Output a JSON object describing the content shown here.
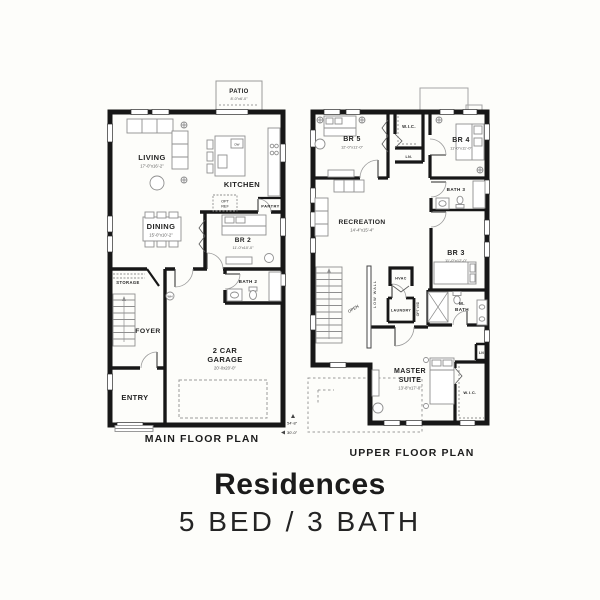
{
  "title": {
    "heading": "Residences",
    "subheading": "5 BED / 3 BATH"
  },
  "main_floor": {
    "caption": "MAIN FLOOR PLAN",
    "depth_marker": "54'-8\"",
    "width_marker": "30'-0\"",
    "rooms": {
      "patio": {
        "name": "PATIO",
        "dim": "8'-0\"x6'-0\""
      },
      "living": {
        "name": "LIVING",
        "dim": "17'-0\"x16'-2\""
      },
      "kitchen": {
        "name": "KITCHEN",
        "dishwasher": "DW"
      },
      "opt_ref": {
        "line1": "OPT",
        "line2": "REF"
      },
      "pantry": {
        "name": "PANTRY"
      },
      "dining": {
        "name": "DINING",
        "dim": "15'-0\"x10'-2\""
      },
      "br2": {
        "name": "BR 2",
        "dim": "11'-0\"x10'-0\""
      },
      "bath2": {
        "name": "BATH 2"
      },
      "storage": {
        "name": "STORAGE"
      },
      "foyer": {
        "name": "FOYER"
      },
      "water_heater": "W/H",
      "entry": {
        "name": "ENTRY"
      },
      "garage": {
        "line1": "2 CAR",
        "line2": "GARAGE",
        "dim": "20'-0x20'-0\""
      }
    }
  },
  "upper_floor": {
    "caption": "UPPER FLOOR PLAN",
    "rooms": {
      "br5": {
        "name": "BR 5",
        "dim": "12'-0\"x11'-0\""
      },
      "wic_hall": {
        "name": "W.I.C."
      },
      "linen_hall": {
        "name": "LN."
      },
      "br4": {
        "name": "BR 4",
        "dim": "11'-0\"x11'-0\""
      },
      "bath3": {
        "name": "BATH 3"
      },
      "recreation": {
        "name": "RECREATION",
        "dim": "14'-4\"x15'-4\""
      },
      "br3": {
        "name": "BR 3",
        "dim": "11'-0\"x12'-0\""
      },
      "hvac": {
        "name": "HVAC"
      },
      "low_wall": {
        "name": "LOW WALL"
      },
      "stair_open": {
        "name": "OPEN"
      },
      "laundry": {
        "name": "LAUNDRY"
      },
      "opt_wd": {
        "name": "OPT W/D"
      },
      "master_bath": {
        "line1": "M.",
        "line2": "BATH"
      },
      "master_suite": {
        "line1": "MASTER",
        "line2": "SUITE",
        "dim": "13'-8\"x17'-0\""
      },
      "wic_master": {
        "name": "W.I.C."
      },
      "linen_master": {
        "name": "LN"
      }
    }
  }
}
